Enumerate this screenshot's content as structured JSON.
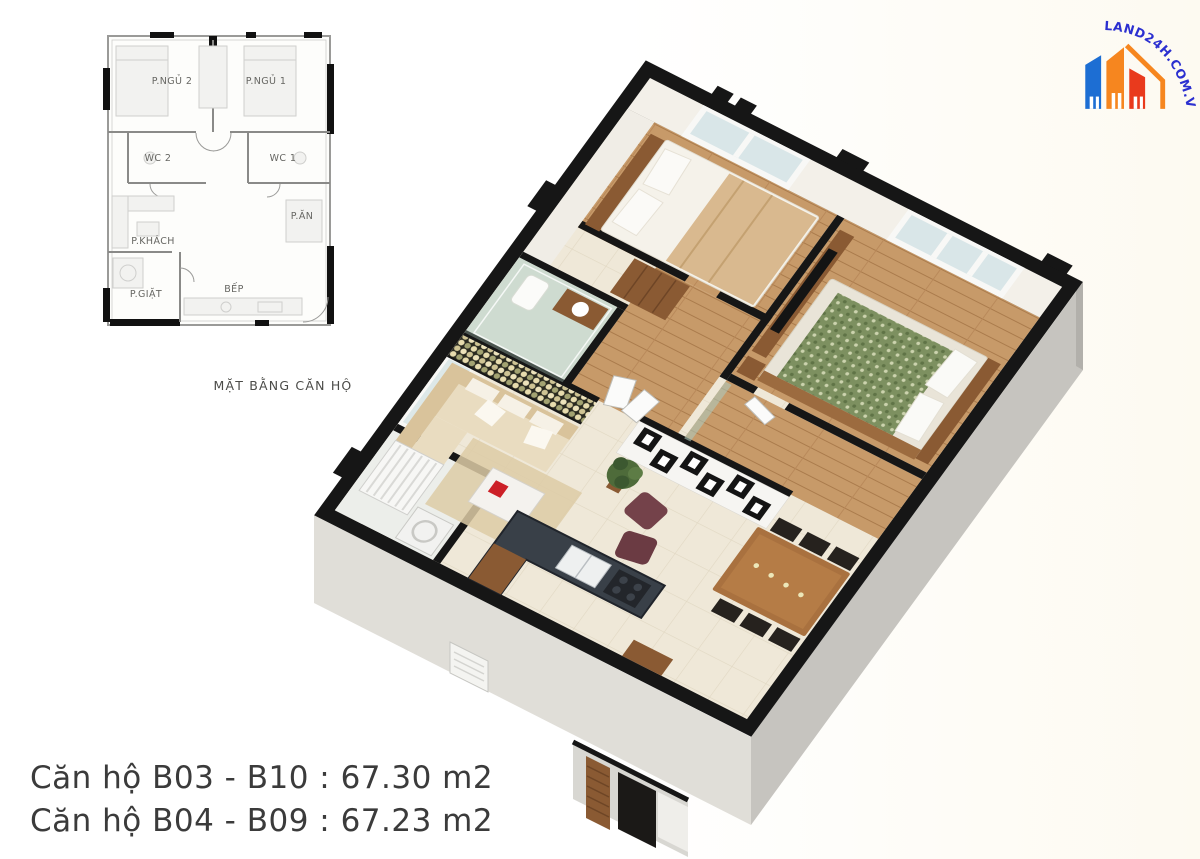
{
  "page": {
    "background_left": "#ffffff",
    "background_right": "#fdfaf1"
  },
  "logo": {
    "text": "LAND24H.COM.VN",
    "text_color": "#2b2fd0",
    "buildings": {
      "left": "#1d6ed3",
      "middle": "#f6861f",
      "right": "#e93a1d"
    }
  },
  "plan_2d": {
    "caption": "MẶT BẰNG CĂN HỘ",
    "rooms": [
      {
        "label": "P.NGỦ 2"
      },
      {
        "label": "P.NGỦ 1"
      },
      {
        "label": "WC 2"
      },
      {
        "label": "WC 1"
      },
      {
        "label": "P.ĂN"
      },
      {
        "label": "P.KHÁCH"
      },
      {
        "label": "P.GIẶT"
      },
      {
        "label": "BẾP"
      }
    ]
  },
  "render_3d": {
    "colors": {
      "wall_top": "#161616",
      "wall_face_light": "#e0ded8",
      "wall_face_dark": "#c6c4bf",
      "floor_wood": "#c79a69",
      "floor_tile": "#efe8d8",
      "glass": "#aecabc",
      "counter": "#394048",
      "accent_red": "#cc2027"
    }
  },
  "units": [
    {
      "label": "Căn hộ B03 - B10 : 67.30 m2"
    },
    {
      "label": "Căn hộ B04 - B09 : 67.23 m2"
    }
  ]
}
